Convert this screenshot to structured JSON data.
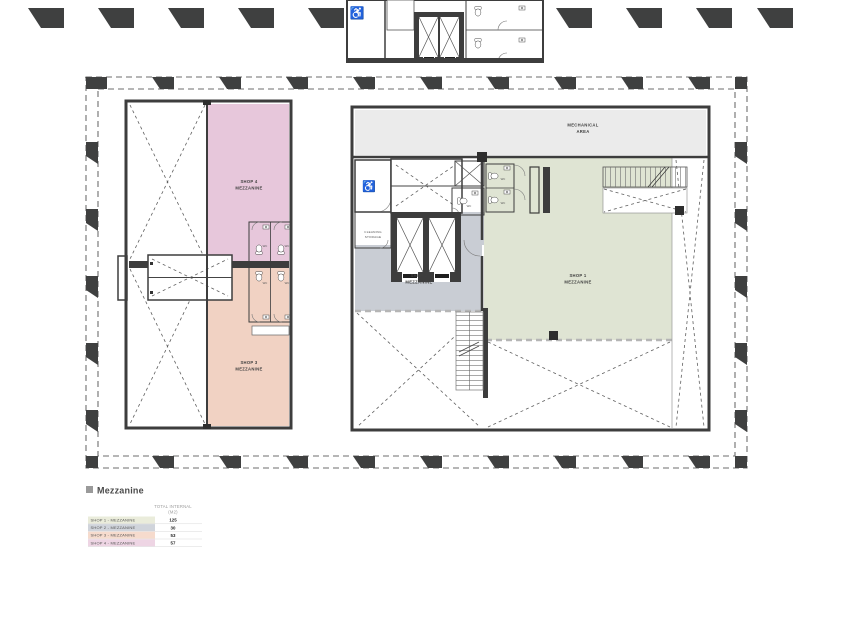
{
  "legend": {
    "title": "Mezzanine",
    "header": {
      "line1": "TOTAL INTERNAL",
      "line2": "(M2)"
    },
    "rows": [
      {
        "label": "SHOP 1 - MEZZANINE",
        "value": "125",
        "color": "#eaecdb"
      },
      {
        "label": "SHOP 2 - MEZZANINE",
        "value": "30",
        "color": "#d0d4db"
      },
      {
        "label": "SHOP 3 - MEZZANINE",
        "value": "53",
        "color": "#f6dbcd"
      },
      {
        "label": "SHOP 4 - MEZZANINE",
        "value": "57",
        "color": "#eed5e4"
      }
    ]
  },
  "plan": {
    "shop1": {
      "line1": "SHOP 1",
      "line2": "MEZZANINE"
    },
    "shop2": {
      "line1": "SHOP 2",
      "line2": "MEZZANINE"
    },
    "shop3": {
      "line1": "SHOP 3",
      "line2": "MEZZANINE"
    },
    "shop4": {
      "line1": "SHOP 4",
      "line2": "MEZZANINE"
    },
    "mechanical": {
      "line1": "MECHANICAL",
      "line2": "AREA"
    },
    "cleaning": {
      "line1": "CLEANING",
      "line2": "STORAGE"
    },
    "wc": "WC",
    "wheelchair_icon": "♿"
  },
  "colors": {
    "shop1_fill": "#dfe4d3",
    "shop2_fill": "#c9cdd4",
    "shop3_fill": "#f1d2c3",
    "shop4_fill": "#e7c7db",
    "mech_fill": "#ebebeb",
    "wall": "#3d3d3d",
    "column_marker": "#3f4040"
  }
}
